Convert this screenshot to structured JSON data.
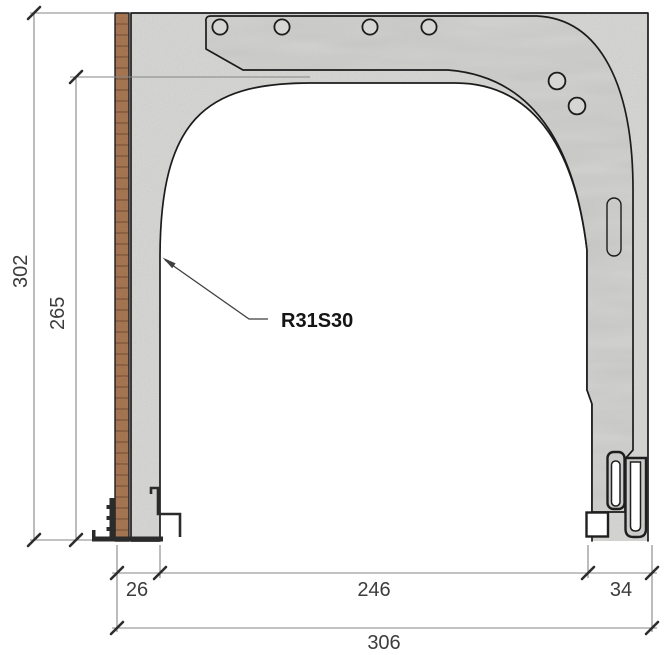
{
  "drawing": {
    "callout": {
      "label": "R31S30"
    },
    "dimensions": {
      "overall_height": "302",
      "opening_height": "265",
      "wall_thickness": "26",
      "opening_width": "246",
      "guide_rail_width": "34",
      "overall_width": "306"
    },
    "materials": {
      "concrete": "#d4d4d2",
      "plate": "#cfcfcd",
      "hole_fill": "#d6d6d4",
      "slot_fill": "#dcdcda",
      "brick": "#a2714d",
      "rail_fill": "#cbcbc9",
      "background": "#ffffff"
    }
  }
}
